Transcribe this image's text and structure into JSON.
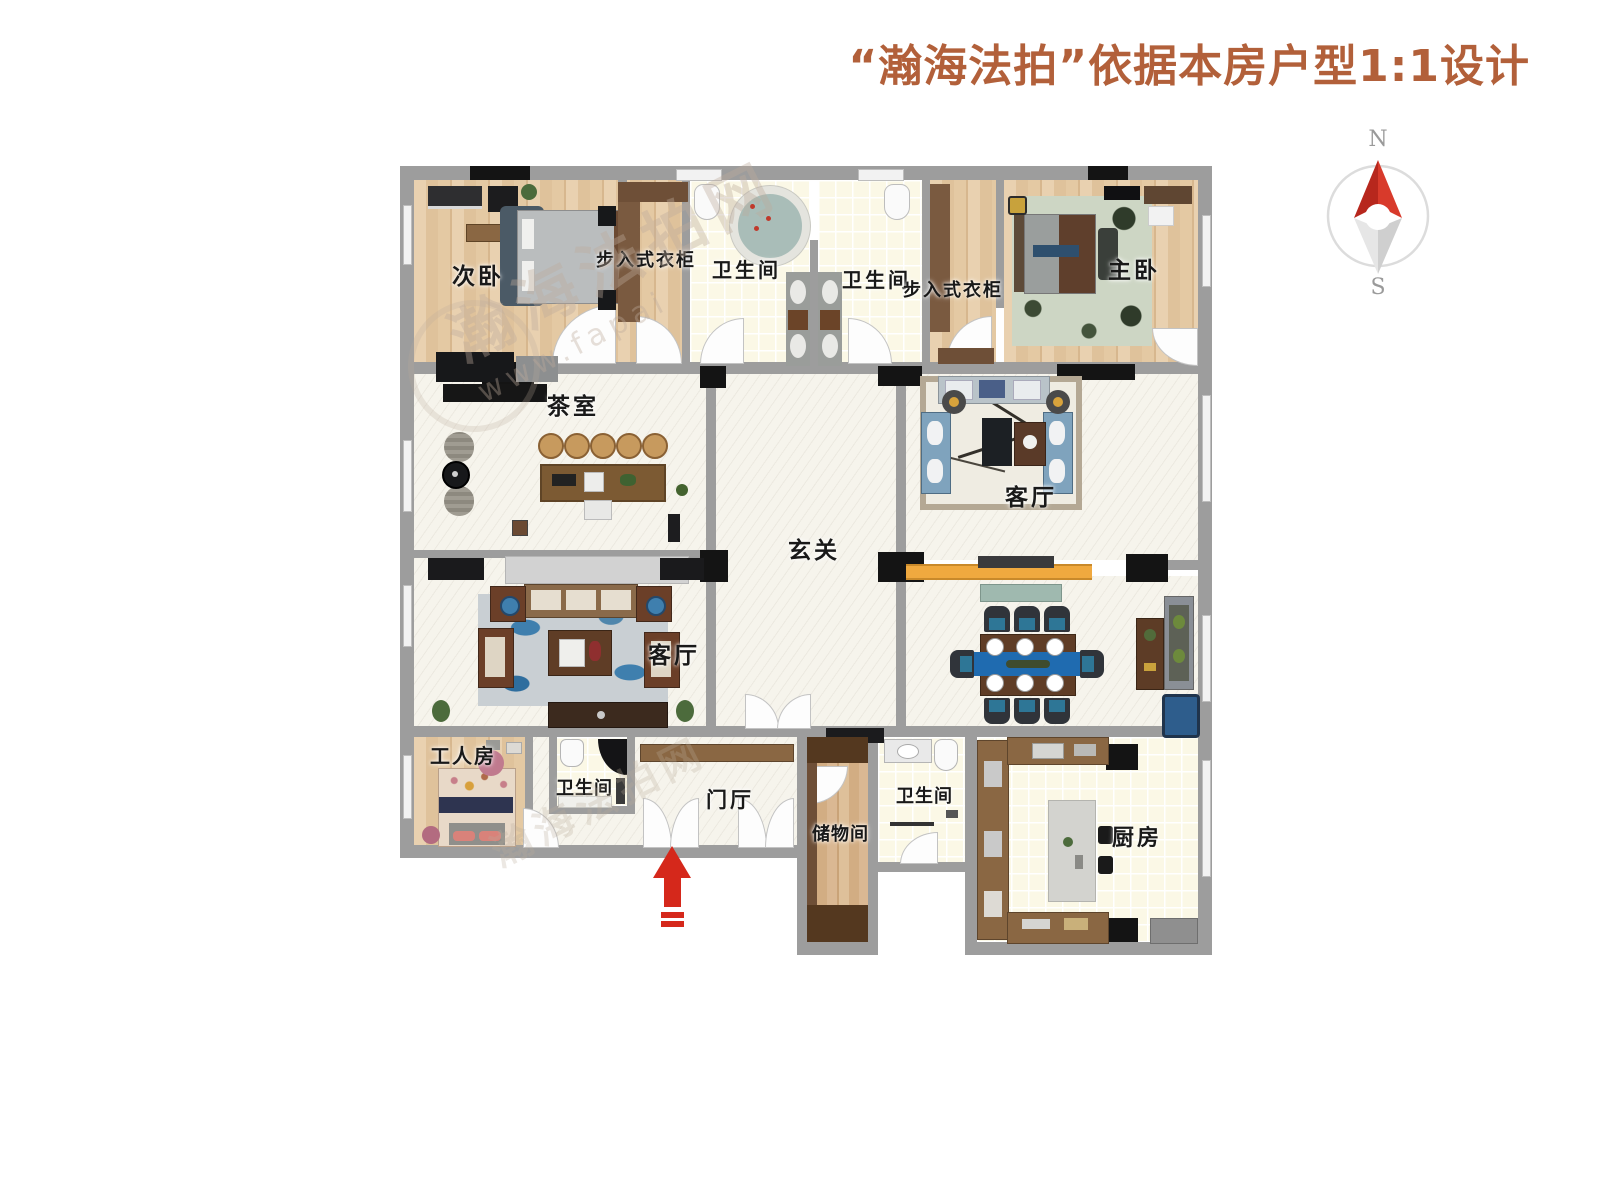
{
  "page": {
    "title": "“瀚海法拍”依据本房户型1:1设计"
  },
  "compass": {
    "north": "N",
    "south": "S"
  },
  "watermark": {
    "line1": "瀚海法拍网",
    "line2": "www.fapai"
  },
  "rooms": {
    "ciwo": "次卧",
    "closet1": "步入式衣柜",
    "bath_a": "卫生间",
    "bath_b": "卫生间",
    "closet2": "步入式衣柜",
    "zhuwo": "主卧",
    "chashi": "茶室",
    "xuanguan": "玄关",
    "keting_r": "客厅",
    "keting_l": "客厅",
    "gongren": "工人房",
    "bath_c": "卫生间",
    "menting": "门厅",
    "chuwu": "储物间",
    "bath_d": "卫生间",
    "chufang": "厨房"
  },
  "colors": {
    "title": "#b2603a",
    "wall": "#9d9d9d",
    "entrance_arrow": "#d5281b",
    "compass_north": "#cf2b20",
    "accent_beam": "#f0a93f",
    "dining_runner": "#1f6bb0"
  }
}
